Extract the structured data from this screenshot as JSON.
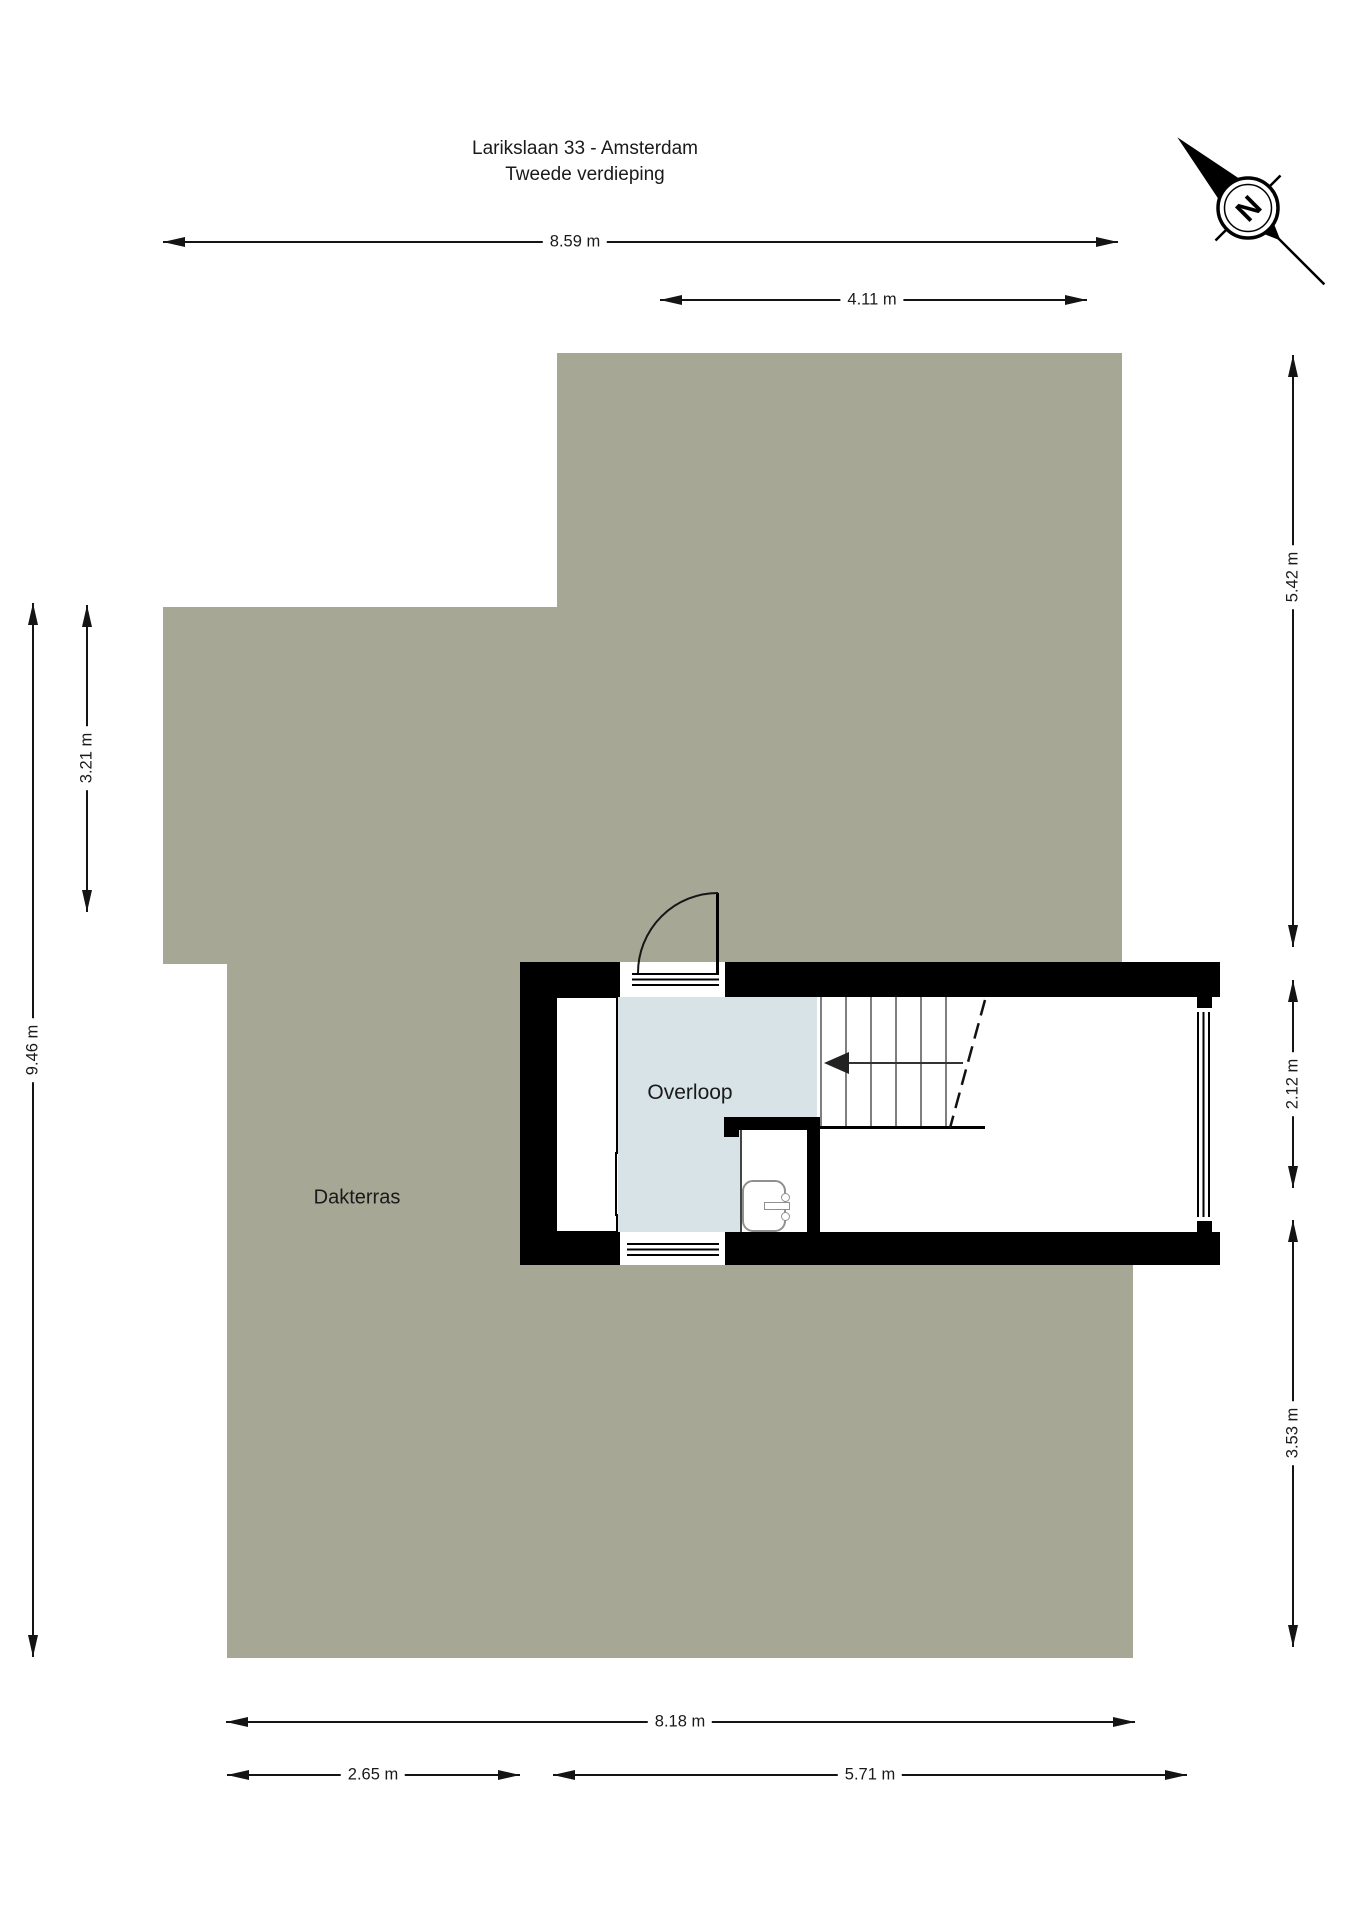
{
  "title": {
    "line1": "Larikslaan 33 - Amsterdam",
    "line2": "Tweede verdieping"
  },
  "labels": {
    "overloop": "Overloop",
    "dakterras": "Dakterras",
    "compass_n": "N"
  },
  "colors": {
    "terrace": "#a6a795",
    "room_fill": "#d7e3e7",
    "wall": "#000000",
    "dim": "#141414",
    "tread": "#7f7f7f",
    "background": "#ffffff"
  },
  "dimensions": [
    {
      "label": "8.59 m",
      "orient": "h",
      "x1": 163,
      "x2": 1118,
      "y": 242,
      "t": 575
    },
    {
      "label": "4.11 m",
      "orient": "h",
      "x1": 660,
      "x2": 1087,
      "y": 300,
      "t": 872
    },
    {
      "label": "3.21 m",
      "orient": "v",
      "x": 87,
      "y1": 605,
      "y2": 912,
      "t": 758
    },
    {
      "label": "9.46 m",
      "orient": "v",
      "x": 33,
      "y1": 603,
      "y2": 1657,
      "t": 1050
    },
    {
      "label": "5.42 m",
      "orient": "v",
      "x": 1293,
      "y1": 355,
      "y2": 947,
      "t": 577
    },
    {
      "label": "2.12 m",
      "orient": "v",
      "x": 1293,
      "y1": 980,
      "y2": 1188,
      "t": 1084
    },
    {
      "label": "3.53 m",
      "orient": "v",
      "x": 1293,
      "y1": 1220,
      "y2": 1647,
      "t": 1433
    },
    {
      "label": "8.18 m",
      "orient": "h",
      "x1": 226,
      "x2": 1135,
      "y": 1722,
      "t": 680
    },
    {
      "label": "2.65 m",
      "orient": "h",
      "x1": 227,
      "x2": 520,
      "y": 1775,
      "t": 373
    },
    {
      "label": "5.71 m",
      "orient": "h",
      "x1": 553,
      "x2": 1187,
      "y": 1775,
      "t": 870
    }
  ]
}
